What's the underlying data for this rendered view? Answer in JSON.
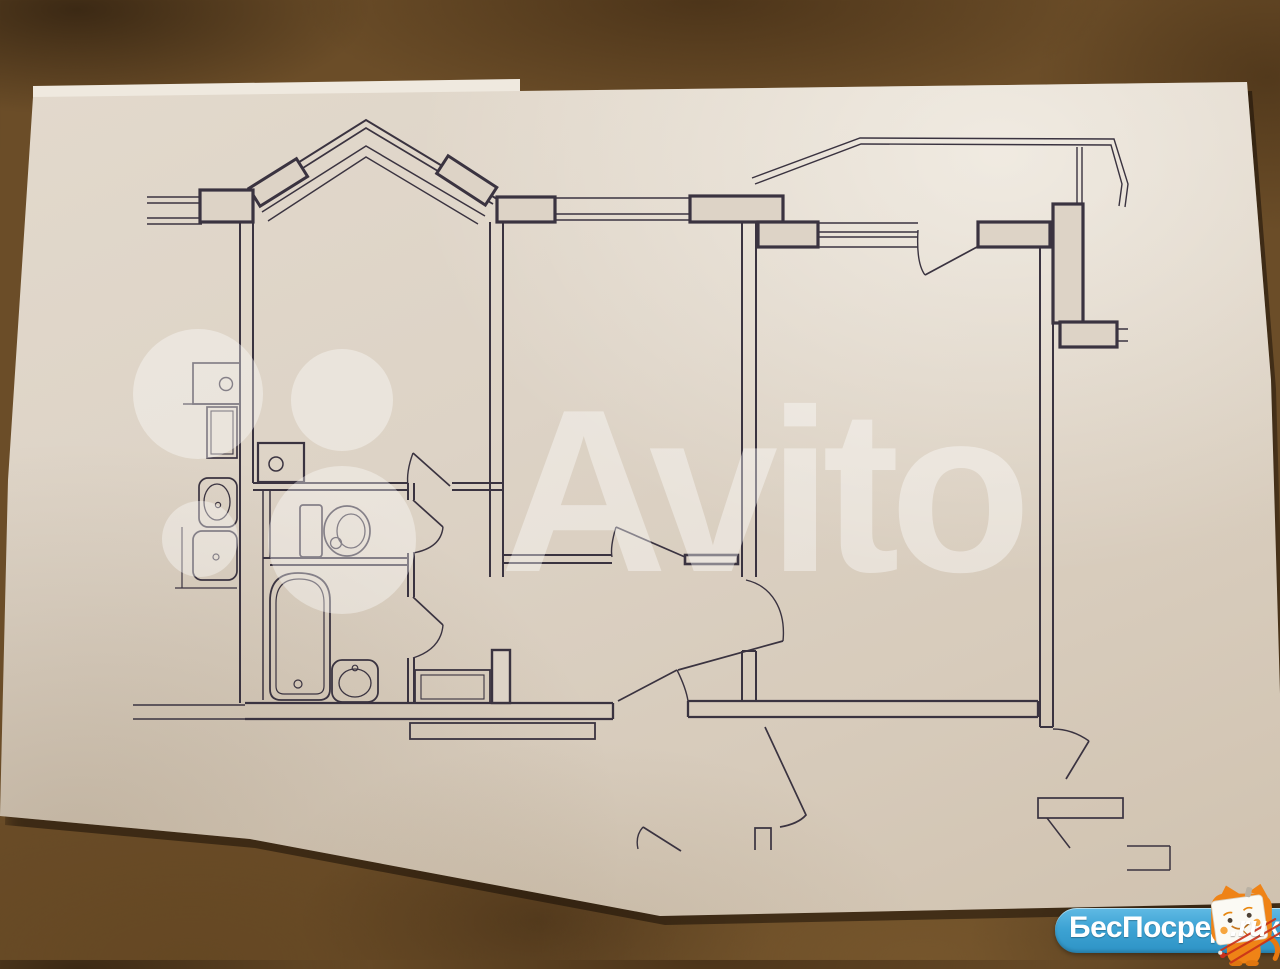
{
  "photo": {
    "scene": "paper apartment floor plan photographed on brown carpet",
    "carpet_color": "#6b4d28",
    "paper_color": "#ddd3c6",
    "ink_color": "#3a3340"
  },
  "watermark": {
    "brand_text": "Avito",
    "text_color": "rgba(255,255,255,0.40)",
    "logo_circle_count": 4
  },
  "badge": {
    "site_name": "БесПосредника",
    "domain_suffix": ".ru",
    "pill_color": "#3da3d4",
    "text_color": "#ffffff",
    "mascot": "orange-cat-tv-mascot",
    "mascot_color": "#ef8316",
    "strike_color": "#c93019"
  },
  "floor_plan": {
    "type": "two-room apartment blueprint, line drawing, no text labels",
    "rooms": [
      "kitchen-with-bay-window",
      "toilet-room",
      "bathroom",
      "hallway",
      "middle-room",
      "right-room",
      "top-right-balcony",
      "bottom-right-balcony",
      "stair-corridor"
    ],
    "fixtures": [
      "stove",
      "kitchen-cabinet",
      "kitchen-sink",
      "vent-shaft",
      "toilet",
      "bathtub",
      "wash-basin",
      "washing-machine"
    ],
    "openings": [
      "bay-window",
      "middle-room-window",
      "right-room-window",
      "balcony-door",
      "kitchen-door",
      "toilet-door",
      "bathroom-door",
      "middle-room-door",
      "right-room-door",
      "entrance-door"
    ]
  }
}
